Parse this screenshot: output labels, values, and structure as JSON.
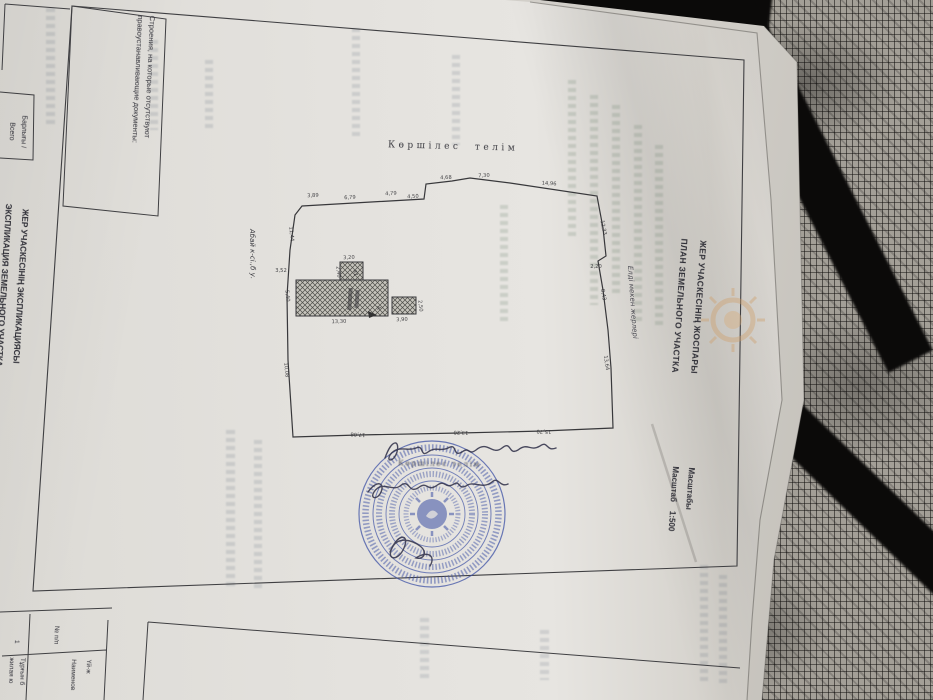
{
  "colors": {
    "stamp_blue": "#3d51a5",
    "paper": "#e3e1dc",
    "ink": "#3b3b3b",
    "fabric": "#a39f97"
  },
  "title_block": {
    "line1": "ЖЕР УЧАСКЕСІНІҢ ЖОСПАРЫ",
    "line2": "ПЛАН ЗЕМЕЛЬНОГО УЧАСТКА",
    "scale_label_kk": "Масштабы",
    "scale_label_ru": "Масштаб",
    "scale_value": "1:500"
  },
  "left_margin": {
    "line1": "ЖЕР УЧАСКЕСІНІҢ ЭКСПЛИКАЦИЯСЫ",
    "line2": "ЭКСПЛИКАЦИЯ ЗЕМЕЛЬНОГО УЧАСТКА"
  },
  "notes": {
    "structures_line1": "Строения, на которые отсутствуют",
    "structures_line2": "правоустанавливающие документы:",
    "total_line1": "Барлығы /",
    "total_line2": "Всего"
  },
  "table": {
    "header_num": "№ п/п",
    "header_name_kk": "Үй-ж",
    "header_name_ru": "Наименов",
    "row_num": "1",
    "row_name_kk": "Тұрғын б",
    "row_name_ru": "жилая ю"
  },
  "diagram": {
    "neighbor_top": "Көршілес телім",
    "neighbor_right": "Елді мекен жерлері",
    "street": "Абай к-сі.,б у.",
    "stamp_caption": "Көршілес телім",
    "dimensions": {
      "top": [
        "3,89",
        "6,79",
        "4,79",
        "4,50",
        "4,68",
        "7,30",
        "14,96"
      ],
      "right": [
        "12,33",
        "2,20",
        "8,43",
        "13,64"
      ],
      "bottom": [
        "17,08",
        "13,20",
        "15,70"
      ],
      "left": [
        "11,44",
        "3,52",
        "5,40",
        "10,08"
      ],
      "buildings": [
        "3,20",
        "2,40",
        "а1",
        "13,30",
        "3,90",
        "2,50",
        "А"
      ]
    }
  }
}
